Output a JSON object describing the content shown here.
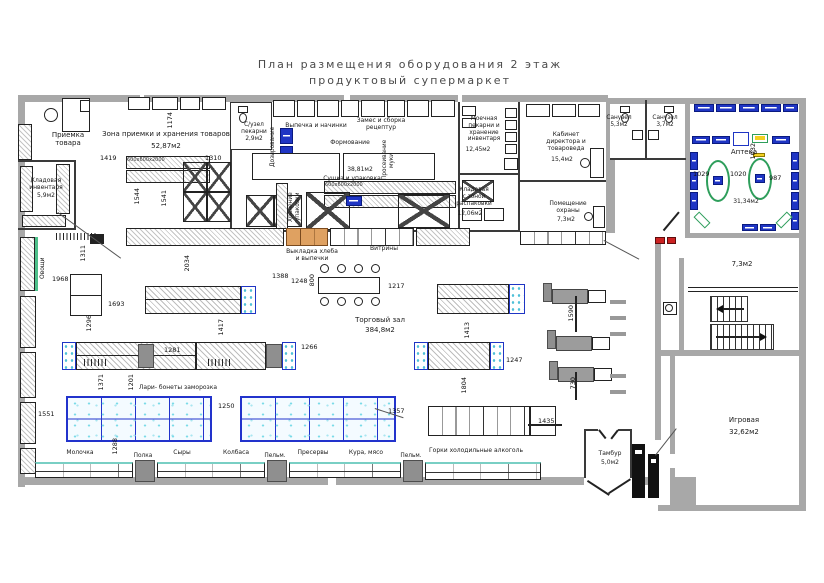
{
  "title": {
    "line1": "План  размещения  оборудования  2  этаж",
    "line2": "продуктовый  супермаркет"
  },
  "rooms": {
    "priemka": {
      "label": "Приемка\nтовара"
    },
    "zona": {
      "label": "Зона приемки и хранения товаров",
      "area": "52,87м2"
    },
    "kladinv": {
      "label": "Кладовая\nинвентаря",
      "area": "5,9м2"
    },
    "su": {
      "label": "С/узел\nпекарни",
      "area": "2,9м2"
    },
    "vypechka": {
      "label": "Выпечка и начинки"
    },
    "zames": {
      "label": "Замес и сборка\nрецептур"
    },
    "formovanie": {
      "label": "Формование"
    },
    "sushka": {
      "label": "Сушка и упаковка",
      "area": "38,81м2"
    },
    "moechnaya": {
      "label": "Моечная\nпекарни и\nхранение\nинвентаря",
      "area": "12,45м2"
    },
    "rasp": {
      "label": "Кладовая\nс зоной\nраспаковки",
      "area": "12,06м2"
    },
    "kabinet": {
      "label": "Кабинет\nдиректора и\nтовароведа",
      "area": "15,4м2"
    },
    "okhrana": {
      "label": "Помещение\nохраны",
      "area": "7,3м2"
    },
    "san1": {
      "label": "Санузел",
      "area": "5,3м2"
    },
    "san2": {
      "label": "Санузел",
      "area": "3,7м2"
    },
    "apteka": {
      "label": "Аптека",
      "area": "31,34м2"
    },
    "stairs": {
      "area": "7,3м2"
    },
    "igrovaya": {
      "label": "Игровая",
      "area": "32,62м2"
    },
    "tambur": {
      "label": "Тамбур",
      "area": "5,0м2"
    },
    "torg": {
      "label": "Торговый зал",
      "area": "384,8м2"
    }
  },
  "zones": {
    "bread": "Выкладка хлеба\nи выпечки",
    "vitriny": "Витрины",
    "lari": "Лари- бонеты заморозка",
    "ovoshchi": "Овощи",
    "hran": "Хранение\nупаковки",
    "pros": "Просеивание\nмуки",
    "doz": "Дозирование"
  },
  "bottom": {
    "labels": [
      "Молочка",
      "Полка",
      "Сыры",
      "Колбаса",
      "Пельм.",
      "Пресервы",
      "Кура, мясо",
      "Пельм.",
      "Горки холодильные алкоголь"
    ]
  },
  "dims": [
    "1419",
    "1310",
    "1174",
    "1541",
    "1544",
    "1968",
    "1311",
    "1296",
    "1693",
    "2034",
    "1388",
    "1248",
    "800",
    "1217",
    "1281",
    "1417",
    "1266",
    "1804",
    "1247",
    "1435",
    "1590",
    "730",
    "1413",
    "1371",
    "1201",
    "1250",
    "1288",
    "1551",
    "1357",
    "1029",
    "1020",
    "987",
    "1032"
  ],
  "rack_text": "600х600х2000",
  "colors": {
    "wall": "#a8a8a8",
    "freezer_blue": "#2233cc",
    "shelf_blue": "#1f35c4",
    "green": "#2e9e5b",
    "bread_orange": "#dfa161",
    "case_top_cyan": "#79cfc4",
    "red": "#cc2222",
    "yellow": "#f2d022"
  }
}
